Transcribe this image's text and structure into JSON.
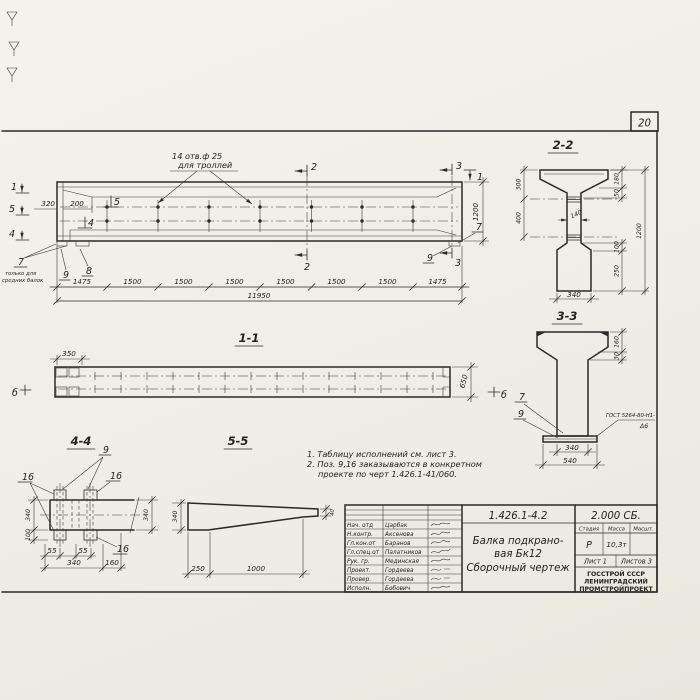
{
  "page": {
    "number": "20"
  },
  "elevation": {
    "holes_note1": "14 отв.ф 25",
    "holes_note2": "для троллей",
    "mark1": "1",
    "mark5": "5",
    "mark4": "4",
    "mark2": "2",
    "mark3": "3",
    "dim320": "320",
    "dim200": "200",
    "dim1200": "1200",
    "callout7": "7",
    "callout9": "9",
    "callout8": "8",
    "note7a": "только для",
    "note7b": "средних балок",
    "seg_dims": [
      "1475",
      "1500",
      "1500",
      "1500",
      "1500",
      "1500",
      "1500",
      "1475"
    ],
    "total_dim": "11950"
  },
  "section22": {
    "label": "2-2",
    "dim300": "300",
    "dim400": "400",
    "dim180": "180",
    "dim50": "50",
    "dim1200": "1200",
    "dim100": "100",
    "dim250": "250",
    "dim140": "140",
    "dim340": "340"
  },
  "section33": {
    "label": "3-3",
    "dim160": "160",
    "dim30": "30",
    "dim340": "340",
    "dim540": "540",
    "callout7": "7",
    "callout9": "9",
    "weld1": "ГОСТ 5264-80-Н1-",
    "weld2": "Δ6"
  },
  "plan11": {
    "label": "1-1",
    "dim350": "350",
    "dim650": "650",
    "mark_b": "б"
  },
  "section44": {
    "label": "4-4",
    "callout9": "9",
    "callout16": "16",
    "dim340l": "340",
    "dim100": "100",
    "dim340r": "340",
    "dim55a": "55",
    "dim55b": "55",
    "dim340b": "340",
    "dim160": "160"
  },
  "view55": {
    "label": "5-5",
    "dim340": "340",
    "dim250": "250",
    "dim1000": "1000",
    "dim40": "40"
  },
  "notes": {
    "line1": "1. Таблицу исполнений см. лист 3.",
    "line2": "2. Поз. 9,16 заказываются в конкретном",
    "line3": "проекте по черт 1.426.1-41/060."
  },
  "titleblock": {
    "doc_number": "1.426.1-4.2",
    "doc_code": "2.000 СБ.",
    "title1": "Балка подкрано-",
    "title2": "вая Бк12",
    "title3": "Сборочный чертеж",
    "h_stage": "Стадия",
    "h_mass": "Масса",
    "h_scale": "Масшт.",
    "stage": "Р",
    "mass": "10,3т",
    "sheet": "Лист 1",
    "sheets": "Листов 3",
    "org1": "ГОССТРОЙ СССР",
    "org2": "ЛЕНИНГРАДСКИЙ",
    "org3": "ПРОМСТРОЙПРОЕКТ",
    "personnel": [
      {
        "role": "Нач. отд",
        "name": "Царбак"
      },
      {
        "role": "Н.контр.",
        "name": "Аксенова"
      },
      {
        "role": "Гл.кон.от",
        "name": "Баранов"
      },
      {
        "role": "Гл.спец.от",
        "name": "Палатников"
      },
      {
        "role": "Рук. гр.",
        "name": "Мединская"
      },
      {
        "role": "Проект.",
        "name": "Гордеева"
      },
      {
        "role": "Провер.",
        "name": "Гордеева"
      },
      {
        "role": "Исполн.",
        "name": "Бобович"
      }
    ]
  }
}
